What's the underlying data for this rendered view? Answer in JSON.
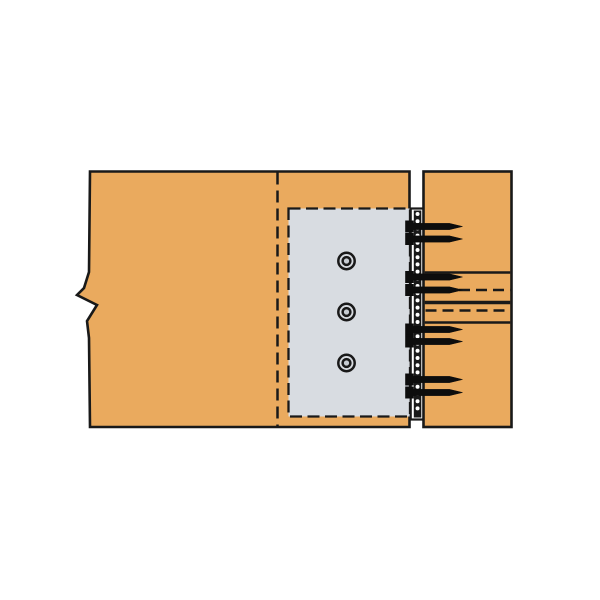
{
  "page": {
    "background_color": "#ffffff"
  },
  "diagram": {
    "name": "concealed-beam-hanger-wood-to-wood-connection-detail",
    "colors": {
      "wood": "#EAAA5E",
      "outline": "#191919",
      "plate": "#D8DCE1",
      "bolt_center_fill": "#C7CCD2",
      "fastener": "#0D0D0D",
      "gap": "#FFFFFF"
    },
    "left_beam": {
      "outline_points": [
        [
          90,
          171.5
        ],
        [
          409.5,
          171.5
        ],
        [
          409.5,
          427
        ],
        [
          90,
          427
        ],
        [
          89,
          338
        ],
        [
          87,
          321
        ],
        [
          97,
          305
        ],
        [
          77,
          295
        ],
        [
          84,
          288
        ],
        [
          89,
          272
        ]
      ],
      "stroke_width": 2.6,
      "hidden_edge_line": {
        "x": 277.5,
        "y1": 172.5,
        "y2": 426,
        "dash": [
          12,
          6
        ],
        "stroke_width": 2.5
      }
    },
    "side_plate": {
      "x": 288.5,
      "y": 208.5,
      "width": 121.5,
      "height": 208,
      "dash": [
        12,
        5.5
      ],
      "stroke_width": 2.3
    },
    "bolts": {
      "cx": 346.5,
      "cy_list": [
        261,
        312,
        363
      ],
      "outer_r": 8.2,
      "inner_r": 3.9,
      "stroke_width": 2.5
    },
    "back_flange": {
      "gap_x1": 410,
      "gap_x2": 423.5,
      "top": 208.5,
      "bottom": 419.5,
      "left_line_x": 410.7,
      "left_line_w": 2.2,
      "cap_stroke_w": 2.2,
      "column": {
        "x": 413.8,
        "width": 7.5,
        "y1": 210.5,
        "y2": 417.5,
        "dot_first_y": 214,
        "dot_pitch": 7.2,
        "dot_r": 2.0
      }
    },
    "right_member": {
      "x": 423.5,
      "y": 171.5,
      "width": 88,
      "height": 255.5,
      "stroke_width": 2.6,
      "line_dash": [
        11,
        6
      ],
      "lines": [
        {
          "y": 272.5,
          "x1": 424.7,
          "x2": 510.3,
          "dashed": false,
          "w": 2.4
        },
        {
          "y": 290.0,
          "x1": 459.0,
          "x2": 510.3,
          "dashed": true,
          "w": 2.4
        },
        {
          "y": 302.5,
          "x1": 424.7,
          "x2": 510.3,
          "dashed": false,
          "w": 3.4
        },
        {
          "y": 310.5,
          "x1": 425.5,
          "x2": 510.3,
          "dashed": true,
          "w": 2.4
        },
        {
          "y": 322.5,
          "x1": 424.7,
          "x2": 510.3,
          "dashed": false,
          "w": 2.4
        }
      ]
    },
    "screws": {
      "count": 8,
      "rows_y": [
        226.5,
        239,
        277,
        290,
        329.5,
        341.5,
        379.5,
        392.5
      ],
      "head_x": 405.5,
      "head_half_h": 5.7,
      "shaft_x": 413.5,
      "shaft_end_x": 449.5,
      "shaft_half_h": 3.1,
      "tip_x": 462.5
    }
  }
}
